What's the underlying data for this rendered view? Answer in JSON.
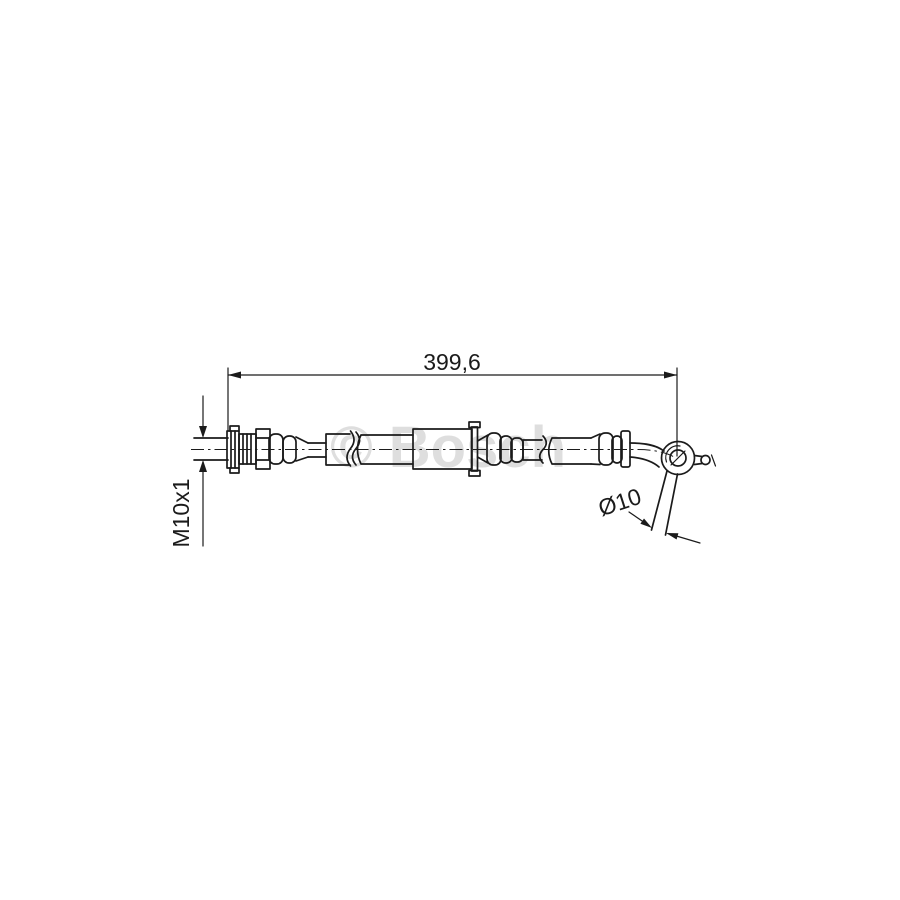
{
  "diagram": {
    "watermark_text": "© Bosch",
    "dimension_length": "399,6",
    "dimension_thread": "M10x1",
    "dimension_diameter": "Ø10",
    "colors": {
      "line": "#1b1b1b",
      "watermark": "#dedede",
      "background": "#ffffff"
    }
  }
}
